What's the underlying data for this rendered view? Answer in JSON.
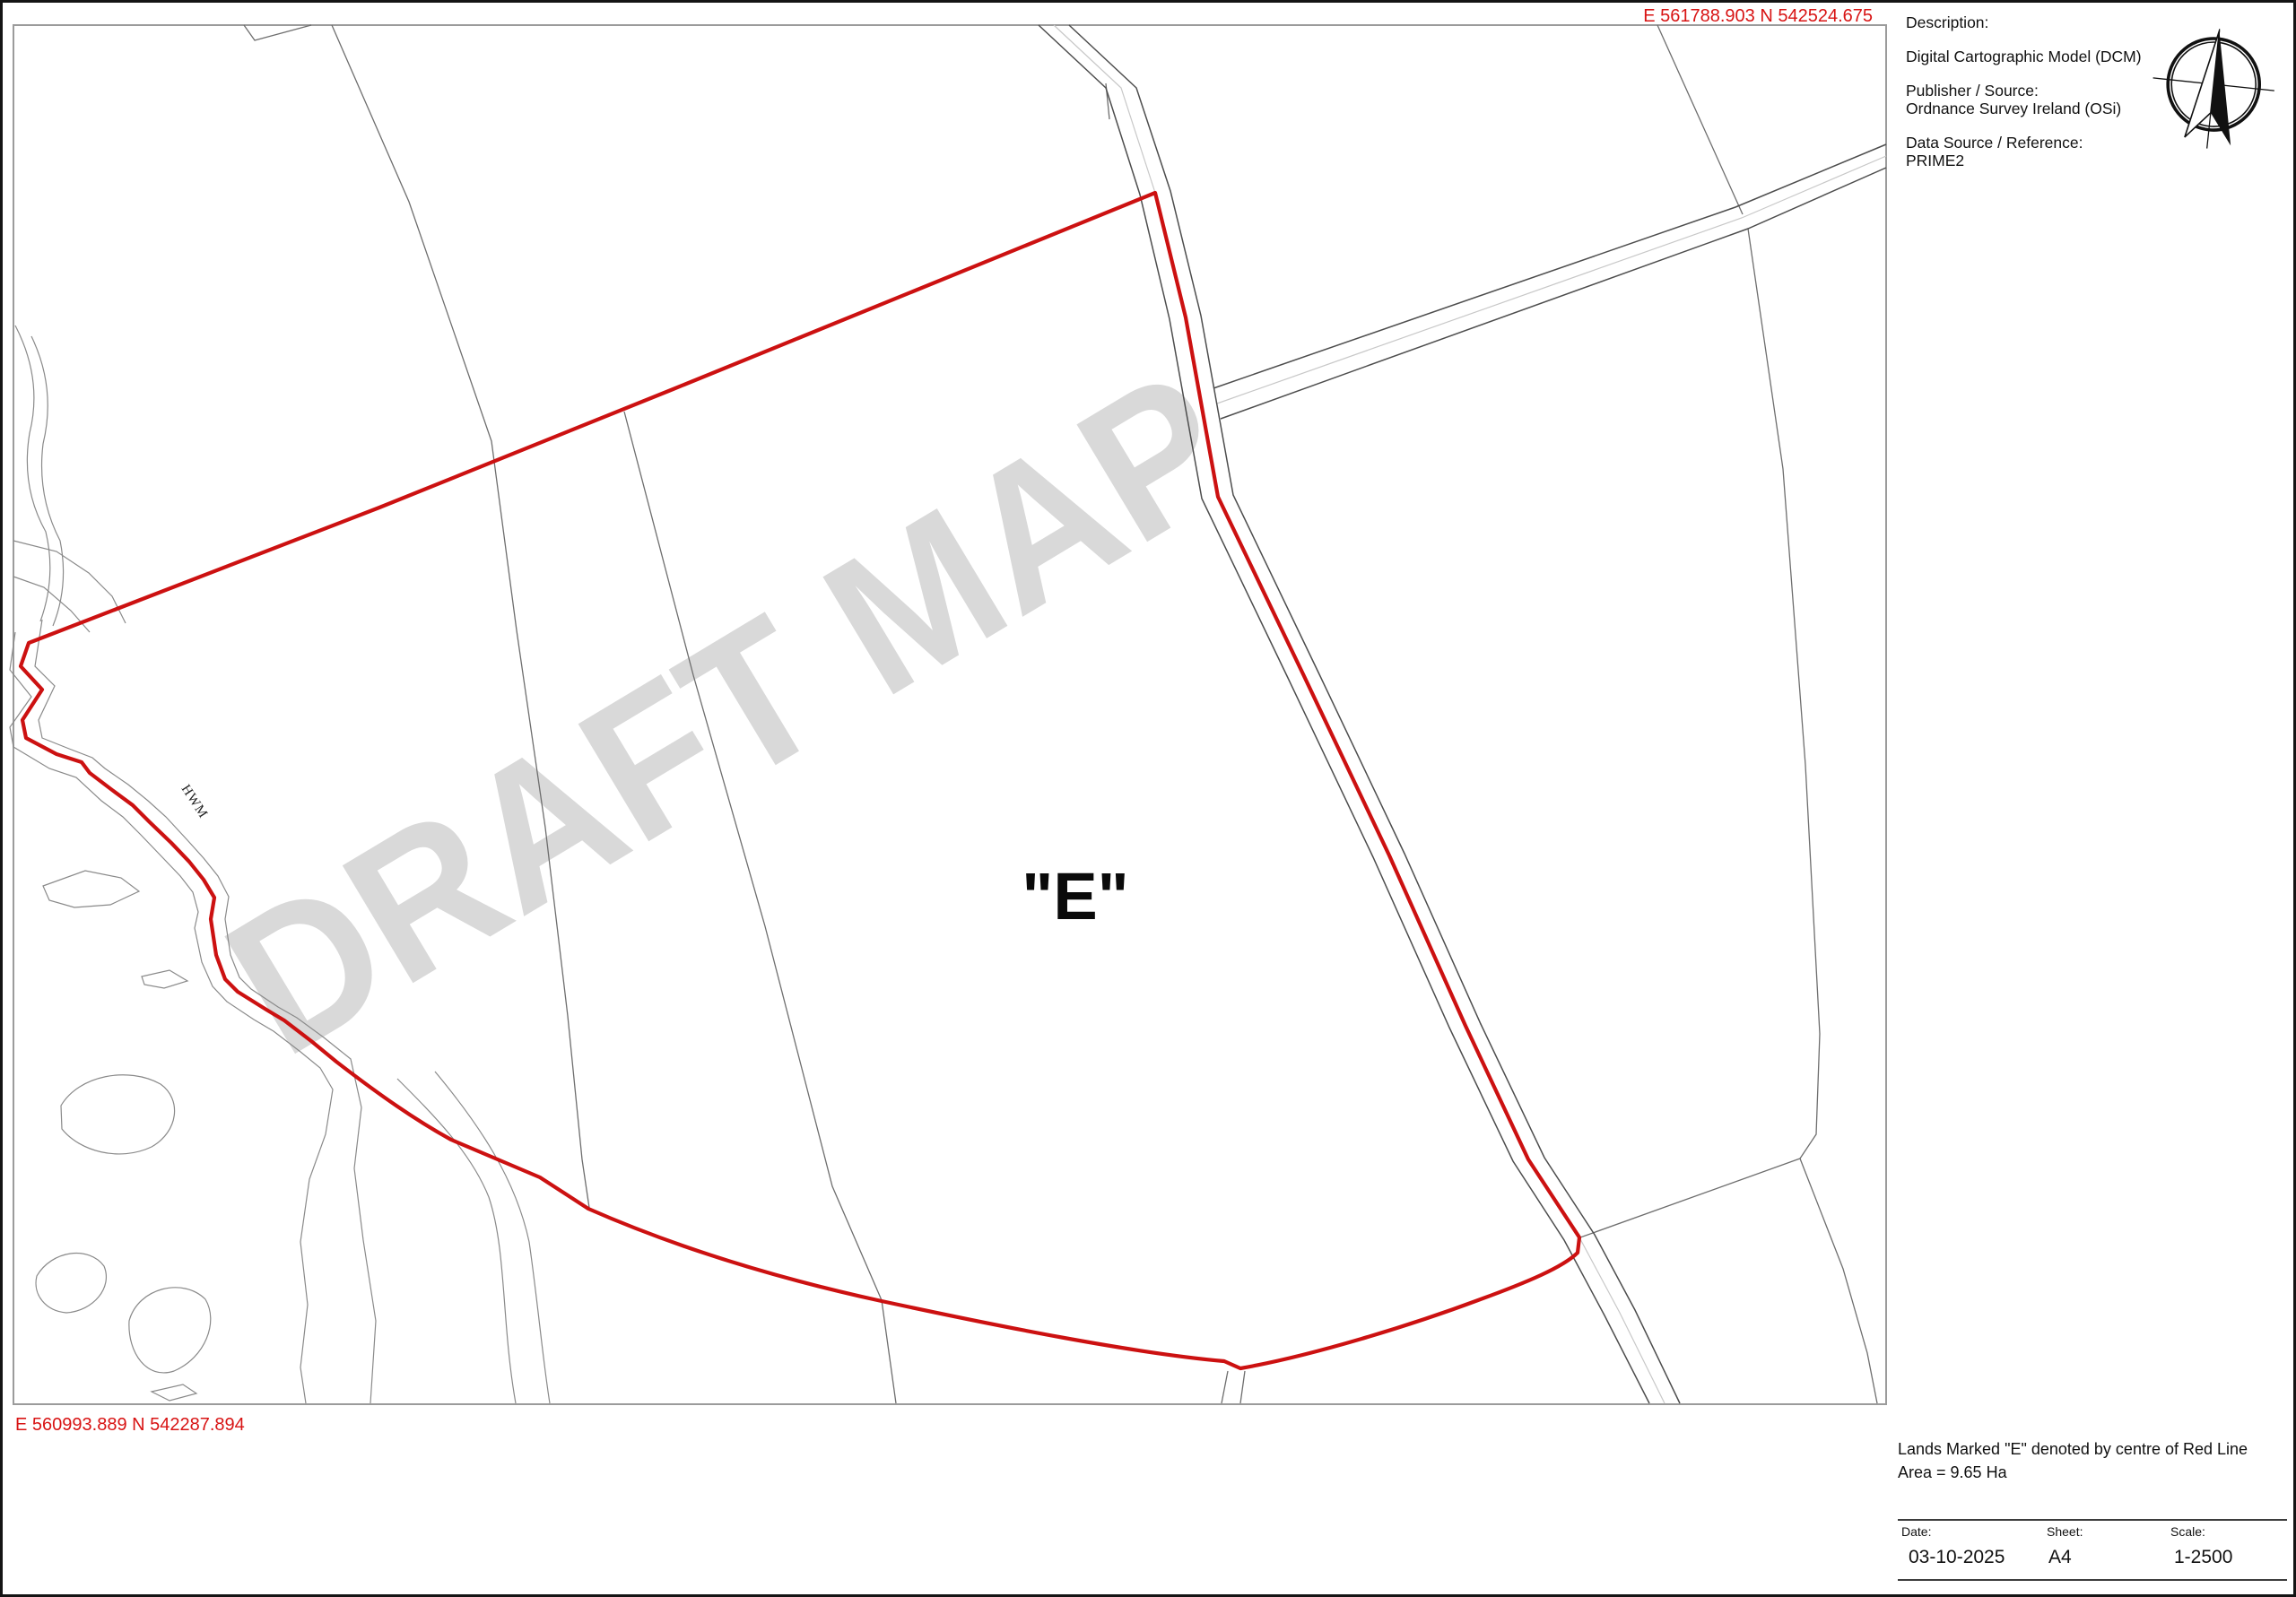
{
  "watermark": "DRAFT MAP",
  "map": {
    "coord_top_right": "E 561788.903 N 542524.675",
    "coord_bottom_left": "E 560993.889  N 542287.894",
    "parcel_label": "\"E\"",
    "hwm_label": "HWM"
  },
  "info_panel": {
    "description_label": "Description:",
    "description_value": "Digital Cartographic Model (DCM)",
    "publisher_label": "Publisher / Source:",
    "publisher_value": "Ordnance Survey Ireland (OSi)",
    "datasource_label": "Data Source / Reference:",
    "datasource_value": "PRIME2",
    "compass_icon": "north-compass"
  },
  "legend": {
    "line1": "Lands Marked \"E\" denoted by centre of Red Line",
    "line2": "Area = 9.65 Ha",
    "date_label": "Date:",
    "date_value": "03-10-2025",
    "sheet_label": "Sheet:",
    "sheet_value": "A4",
    "scale_label": "Scale:",
    "scale_value": "1-2500"
  },
  "colors": {
    "boundary_red": "#cc1111",
    "coord_red": "#d81414",
    "field_line_gray": "#6e6e6e",
    "road_gray": "#4d4d4d",
    "shore_gray": "#8a8a8a",
    "watermark_gray": "#d9d9d9",
    "map_border_gray": "#9b9b9b"
  }
}
